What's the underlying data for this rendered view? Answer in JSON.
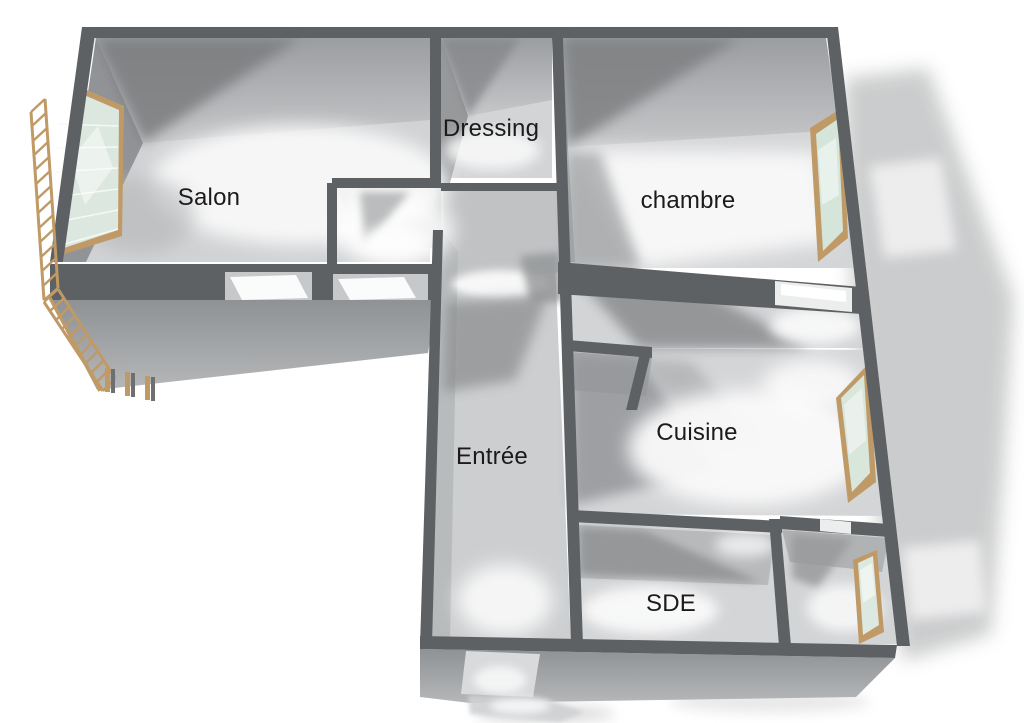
{
  "diagram": {
    "type": "3d-floor-plan",
    "background": "#ffffff",
    "rooms": {
      "salon": {
        "label": "Salon"
      },
      "dressing": {
        "label": "Dressing"
      },
      "chambre": {
        "label": "chambre"
      },
      "entree": {
        "label": "Entrée"
      },
      "cuisine": {
        "label": "Cuisine"
      },
      "sde": {
        "label": "SDE"
      }
    },
    "colors": {
      "wall_top": "#5e6163",
      "wall_face_outer": "#9a9c9e",
      "wall_face_inner": "#b2b4b6",
      "floor": "#d2d4d6",
      "floor_highlight": "#fafafa",
      "floor_shadow": "#8f9193",
      "wood_frame": "#c09a66",
      "window_glass": "#dce7df",
      "drop_shadow": "#c9cacb",
      "label_text": "#1b1b1b"
    },
    "features": {
      "windows": 4,
      "balcony_railing": true,
      "balcony_doors": 2,
      "entry_door": true
    }
  }
}
